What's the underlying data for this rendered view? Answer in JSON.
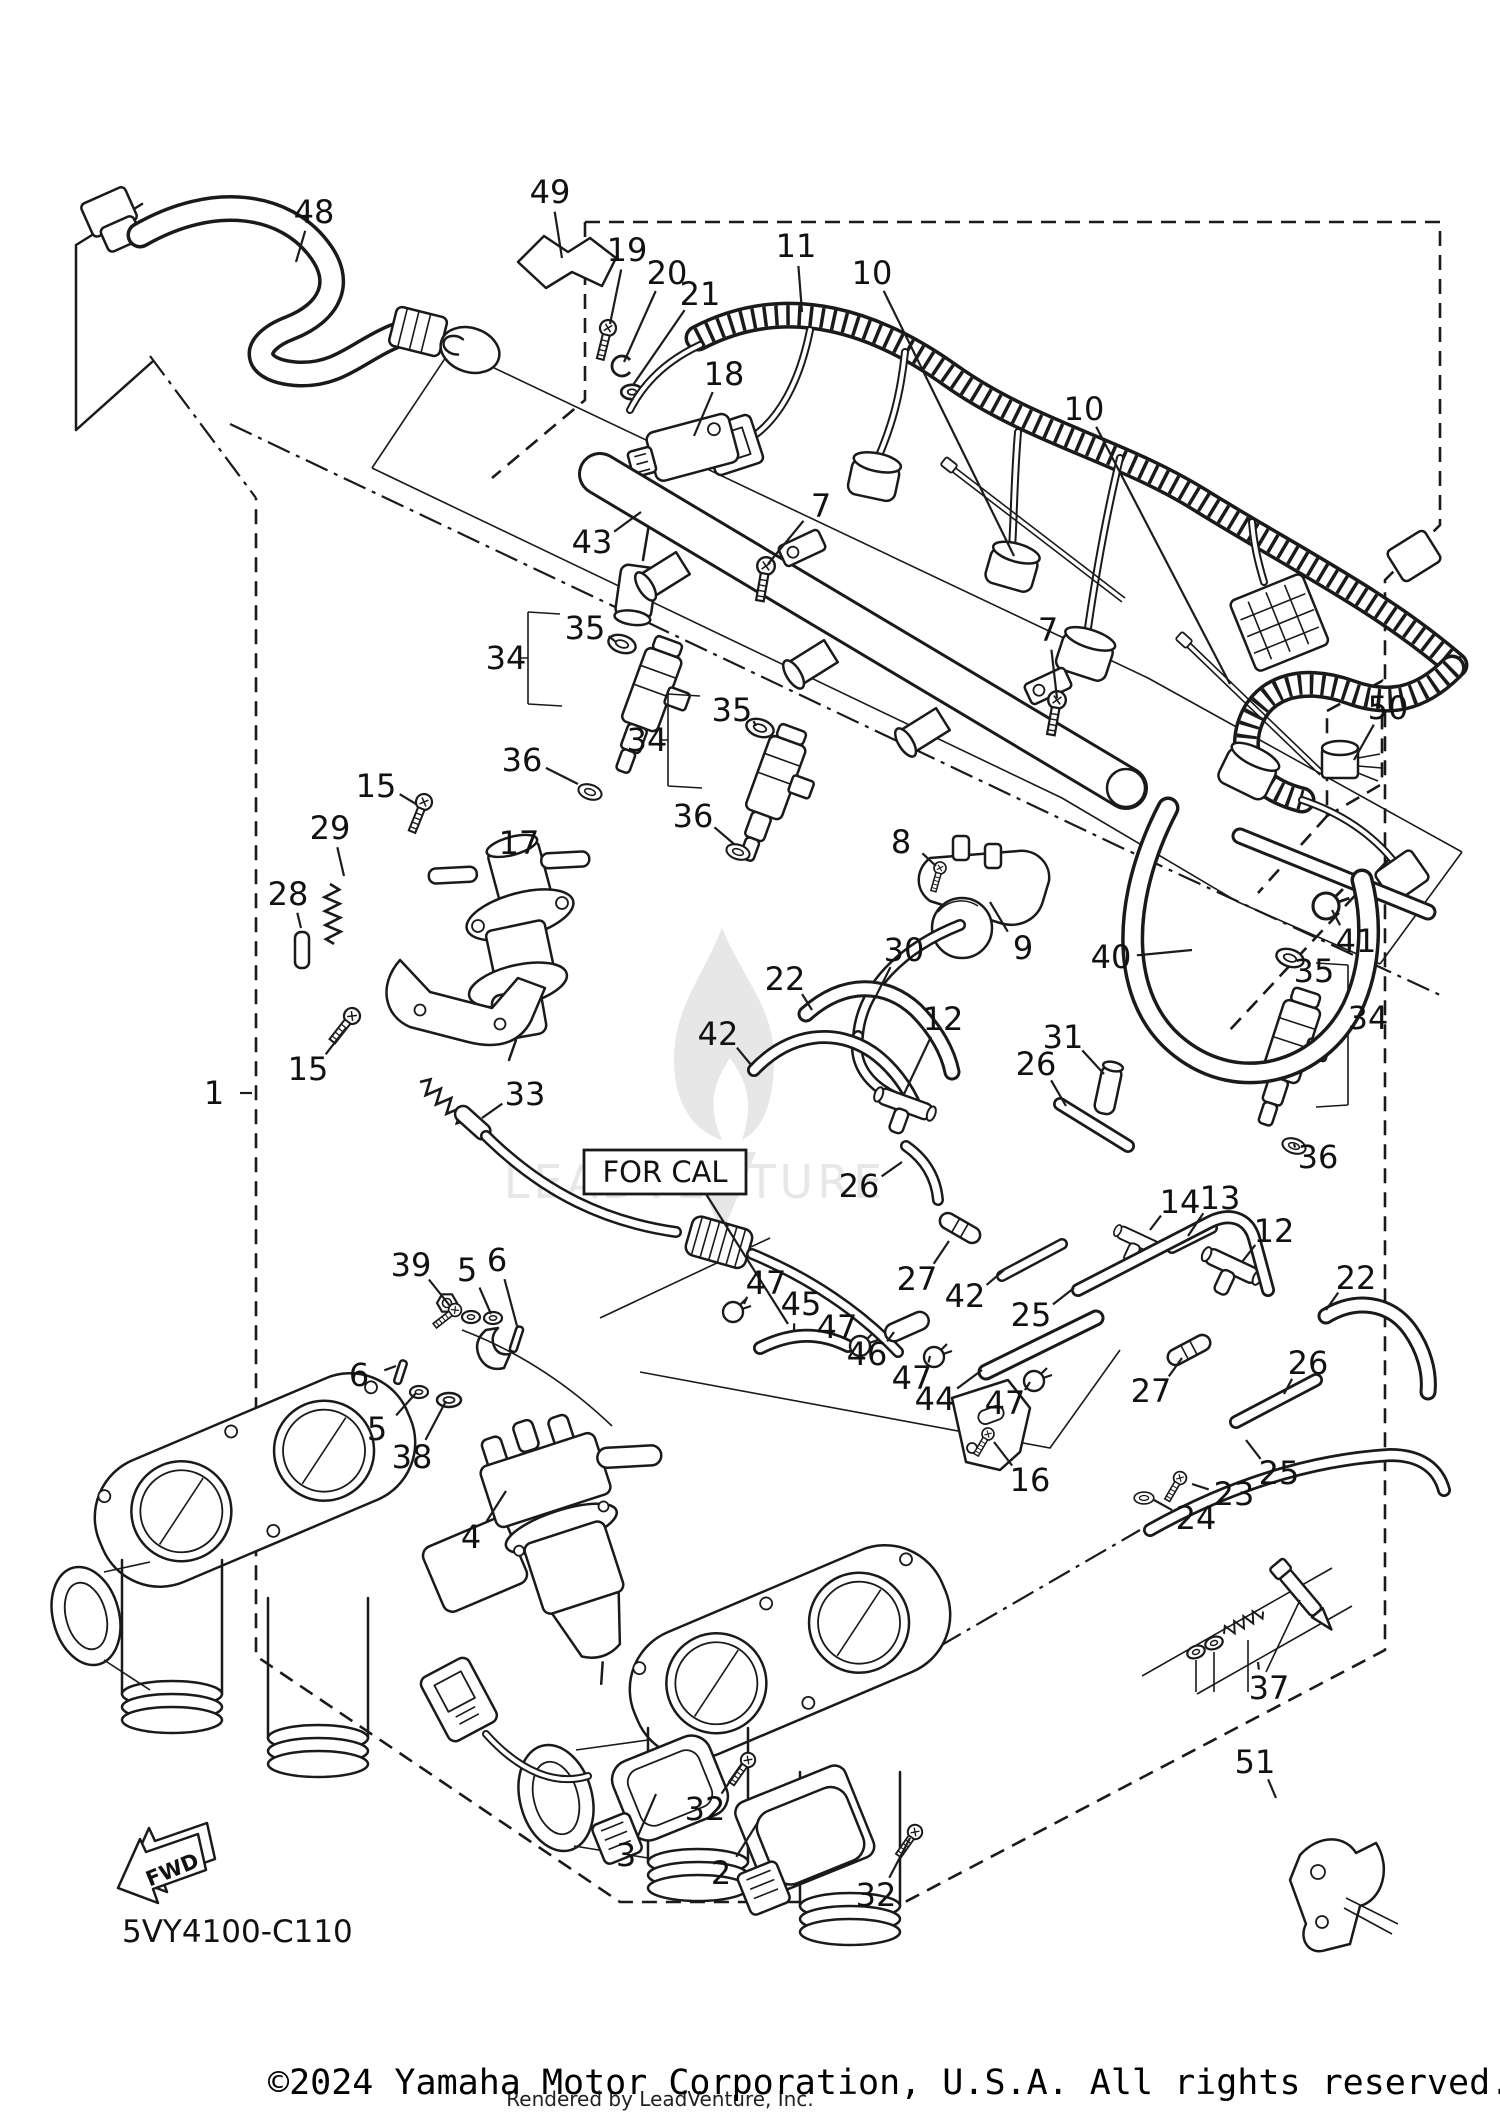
{
  "diagram": {
    "code_label": "5VY4100-C110",
    "for_cal_label": "FOR CAL",
    "fwd_label": "FWD",
    "copyright": "©2024 Yamaha Motor Corporation, U.S.A. All rights reserved.",
    "rendered_by": "Rendered by LeadVenture, Inc.",
    "watermark_text": "LEADVENTURE",
    "colors": {
      "line": "#1a1a1a",
      "watermark": "#e7e7e7",
      "background": "#ffffff"
    },
    "callouts": [
      {
        "t": "48",
        "x": 314,
        "y": 212,
        "tx": 296,
        "ty": 262
      },
      {
        "t": "49",
        "x": 550,
        "y": 192,
        "tx": 562,
        "ty": 258
      },
      {
        "t": "19",
        "x": 627,
        "y": 250,
        "tx": 610,
        "ty": 324
      },
      {
        "t": "20",
        "x": 667,
        "y": 273,
        "tx": 624,
        "ty": 362
      },
      {
        "t": "21",
        "x": 700,
        "y": 294,
        "tx": 633,
        "ty": 385
      },
      {
        "t": "11",
        "x": 796,
        "y": 246,
        "tx": 802,
        "ty": 312
      },
      {
        "t": "10",
        "x": 872,
        "y": 273,
        "tx": 1014,
        "ty": 556
      },
      {
        "t": "10",
        "x": 1084,
        "y": 409,
        "tx": 1230,
        "ty": 684
      },
      {
        "t": "18",
        "x": 724,
        "y": 374,
        "tx": 694,
        "ty": 436
      },
      {
        "t": "43",
        "x": 592,
        "y": 542,
        "tx": 641,
        "ty": 512
      },
      {
        "t": "7",
        "x": 821,
        "y": 506,
        "tx": 768,
        "ty": 564
      },
      {
        "t": "7",
        "x": 1048,
        "y": 630,
        "tx": 1057,
        "ty": 698
      },
      {
        "t": "35",
        "x": 585,
        "y": 628,
        "tx": 616,
        "ty": 642
      },
      {
        "t": "34",
        "x": 506,
        "y": 658,
        "tx": 526,
        "ty": 658
      },
      {
        "t": "36",
        "x": 522,
        "y": 760,
        "tx": 578,
        "ty": 784
      },
      {
        "t": "35",
        "x": 732,
        "y": 710,
        "tx": 756,
        "ty": 726
      },
      {
        "t": "34",
        "x": 647,
        "y": 740,
        "tx": 666,
        "ty": 740
      },
      {
        "t": "36",
        "x": 693,
        "y": 816,
        "tx": 734,
        "ty": 844
      },
      {
        "t": "15",
        "x": 376,
        "y": 786,
        "tx": 416,
        "ty": 804
      },
      {
        "t": "29",
        "x": 330,
        "y": 828,
        "tx": 344,
        "ty": 876
      },
      {
        "t": "17",
        "x": 519,
        "y": 843,
        "tx": 528,
        "ty": 866
      },
      {
        "t": "28",
        "x": 288,
        "y": 894,
        "tx": 301,
        "ty": 928
      },
      {
        "t": "8",
        "x": 901,
        "y": 842,
        "tx": 936,
        "ty": 866
      },
      {
        "t": "9",
        "x": 1023,
        "y": 948,
        "tx": 990,
        "ty": 902
      },
      {
        "t": "30",
        "x": 904,
        "y": 950,
        "tx": 876,
        "ty": 996
      },
      {
        "t": "40",
        "x": 1111,
        "y": 957,
        "tx": 1192,
        "ty": 950
      },
      {
        "t": "41",
        "x": 1356,
        "y": 941,
        "tx": 1332,
        "ty": 910
      },
      {
        "t": "50",
        "x": 1388,
        "y": 708,
        "tx": 1354,
        "ty": 760
      },
      {
        "t": "35",
        "x": 1314,
        "y": 971,
        "tx": 1292,
        "ty": 960
      },
      {
        "t": "34",
        "x": 1368,
        "y": 1018,
        "tx": 1350,
        "ty": 1018
      },
      {
        "t": "36",
        "x": 1318,
        "y": 1157,
        "tx": 1294,
        "ty": 1144
      },
      {
        "t": "15",
        "x": 308,
        "y": 1069,
        "tx": 346,
        "ty": 1028
      },
      {
        "t": "1",
        "x": 214,
        "y": 1093,
        "tx": 252,
        "ty": 1093
      },
      {
        "t": "22",
        "x": 785,
        "y": 979,
        "tx": 812,
        "ty": 1010
      },
      {
        "t": "42",
        "x": 718,
        "y": 1034,
        "tx": 752,
        "ty": 1066
      },
      {
        "t": "12",
        "x": 943,
        "y": 1019,
        "tx": 904,
        "ty": 1094
      },
      {
        "t": "26",
        "x": 1036,
        "y": 1064,
        "tx": 1066,
        "ty": 1106
      },
      {
        "t": "31",
        "x": 1063,
        "y": 1037,
        "tx": 1104,
        "ty": 1074
      },
      {
        "t": "33",
        "x": 525,
        "y": 1094,
        "tx": 482,
        "ty": 1118
      },
      {
        "t": "26",
        "x": 859,
        "y": 1186,
        "tx": 902,
        "ty": 1162
      },
      {
        "t": "27",
        "x": 917,
        "y": 1279,
        "tx": 949,
        "ty": 1241
      },
      {
        "t": "42",
        "x": 965,
        "y": 1296,
        "tx": 1004,
        "ty": 1270
      },
      {
        "t": "14",
        "x": 1180,
        "y": 1202,
        "tx": 1150,
        "ty": 1230
      },
      {
        "t": "13",
        "x": 1220,
        "y": 1198,
        "tx": 1188,
        "ty": 1236
      },
      {
        "t": "12",
        "x": 1274,
        "y": 1231,
        "tx": 1242,
        "ty": 1262
      },
      {
        "t": "22",
        "x": 1356,
        "y": 1278,
        "tx": 1326,
        "ty": 1310
      },
      {
        "t": "26",
        "x": 1308,
        "y": 1363,
        "tx": 1284,
        "ty": 1394
      },
      {
        "t": "27",
        "x": 1151,
        "y": 1391,
        "tx": 1182,
        "ty": 1358
      },
      {
        "t": "25",
        "x": 1031,
        "y": 1315,
        "tx": 1074,
        "ty": 1288
      },
      {
        "t": "25",
        "x": 1279,
        "y": 1473,
        "tx": 1246,
        "ty": 1440
      },
      {
        "t": "23",
        "x": 1234,
        "y": 1494,
        "tx": 1192,
        "ty": 1484
      },
      {
        "t": "24",
        "x": 1196,
        "y": 1518,
        "tx": 1154,
        "ty": 1500
      },
      {
        "t": "16",
        "x": 1030,
        "y": 1480,
        "tx": 994,
        "ty": 1442
      },
      {
        "t": "47",
        "x": 766,
        "y": 1283,
        "tx": 744,
        "ty": 1304
      },
      {
        "t": "45",
        "x": 801,
        "y": 1304,
        "tx": 794,
        "ty": 1330
      },
      {
        "t": "47",
        "x": 837,
        "y": 1327,
        "tx": 856,
        "ty": 1342
      },
      {
        "t": "46",
        "x": 867,
        "y": 1354,
        "tx": 894,
        "ty": 1332
      },
      {
        "t": "47",
        "x": 912,
        "y": 1378,
        "tx": 930,
        "ty": 1356
      },
      {
        "t": "44",
        "x": 935,
        "y": 1399,
        "tx": 982,
        "ty": 1370
      },
      {
        "t": "47",
        "x": 1005,
        "y": 1403,
        "tx": 1030,
        "ty": 1382
      },
      {
        "t": "39",
        "x": 411,
        "y": 1265,
        "tx": 450,
        "ty": 1306
      },
      {
        "t": "5",
        "x": 467,
        "y": 1270,
        "tx": 491,
        "ty": 1314
      },
      {
        "t": "6",
        "x": 497,
        "y": 1260,
        "tx": 517,
        "ty": 1326
      },
      {
        "t": "6",
        "x": 359,
        "y": 1375,
        "tx": 396,
        "ty": 1366
      },
      {
        "t": "5",
        "x": 377,
        "y": 1429,
        "tx": 416,
        "ty": 1393
      },
      {
        "t": "38",
        "x": 412,
        "y": 1457,
        "tx": 446,
        "ty": 1401
      },
      {
        "t": "4",
        "x": 471,
        "y": 1537,
        "tx": 506,
        "ty": 1491
      },
      {
        "t": "3",
        "x": 626,
        "y": 1855,
        "tx": 656,
        "ty": 1794
      },
      {
        "t": "32",
        "x": 705,
        "y": 1809,
        "tx": 742,
        "ty": 1764
      },
      {
        "t": "2",
        "x": 721,
        "y": 1873,
        "tx": 758,
        "ty": 1822
      },
      {
        "t": "32",
        "x": 876,
        "y": 1895,
        "tx": 910,
        "ty": 1838
      },
      {
        "t": "37",
        "x": 1269,
        "y": 1688,
        "tx": 1258,
        "ty": 1662
      },
      {
        "t": "51",
        "x": 1255,
        "y": 1762,
        "tx": 1276,
        "ty": 1798
      }
    ]
  }
}
